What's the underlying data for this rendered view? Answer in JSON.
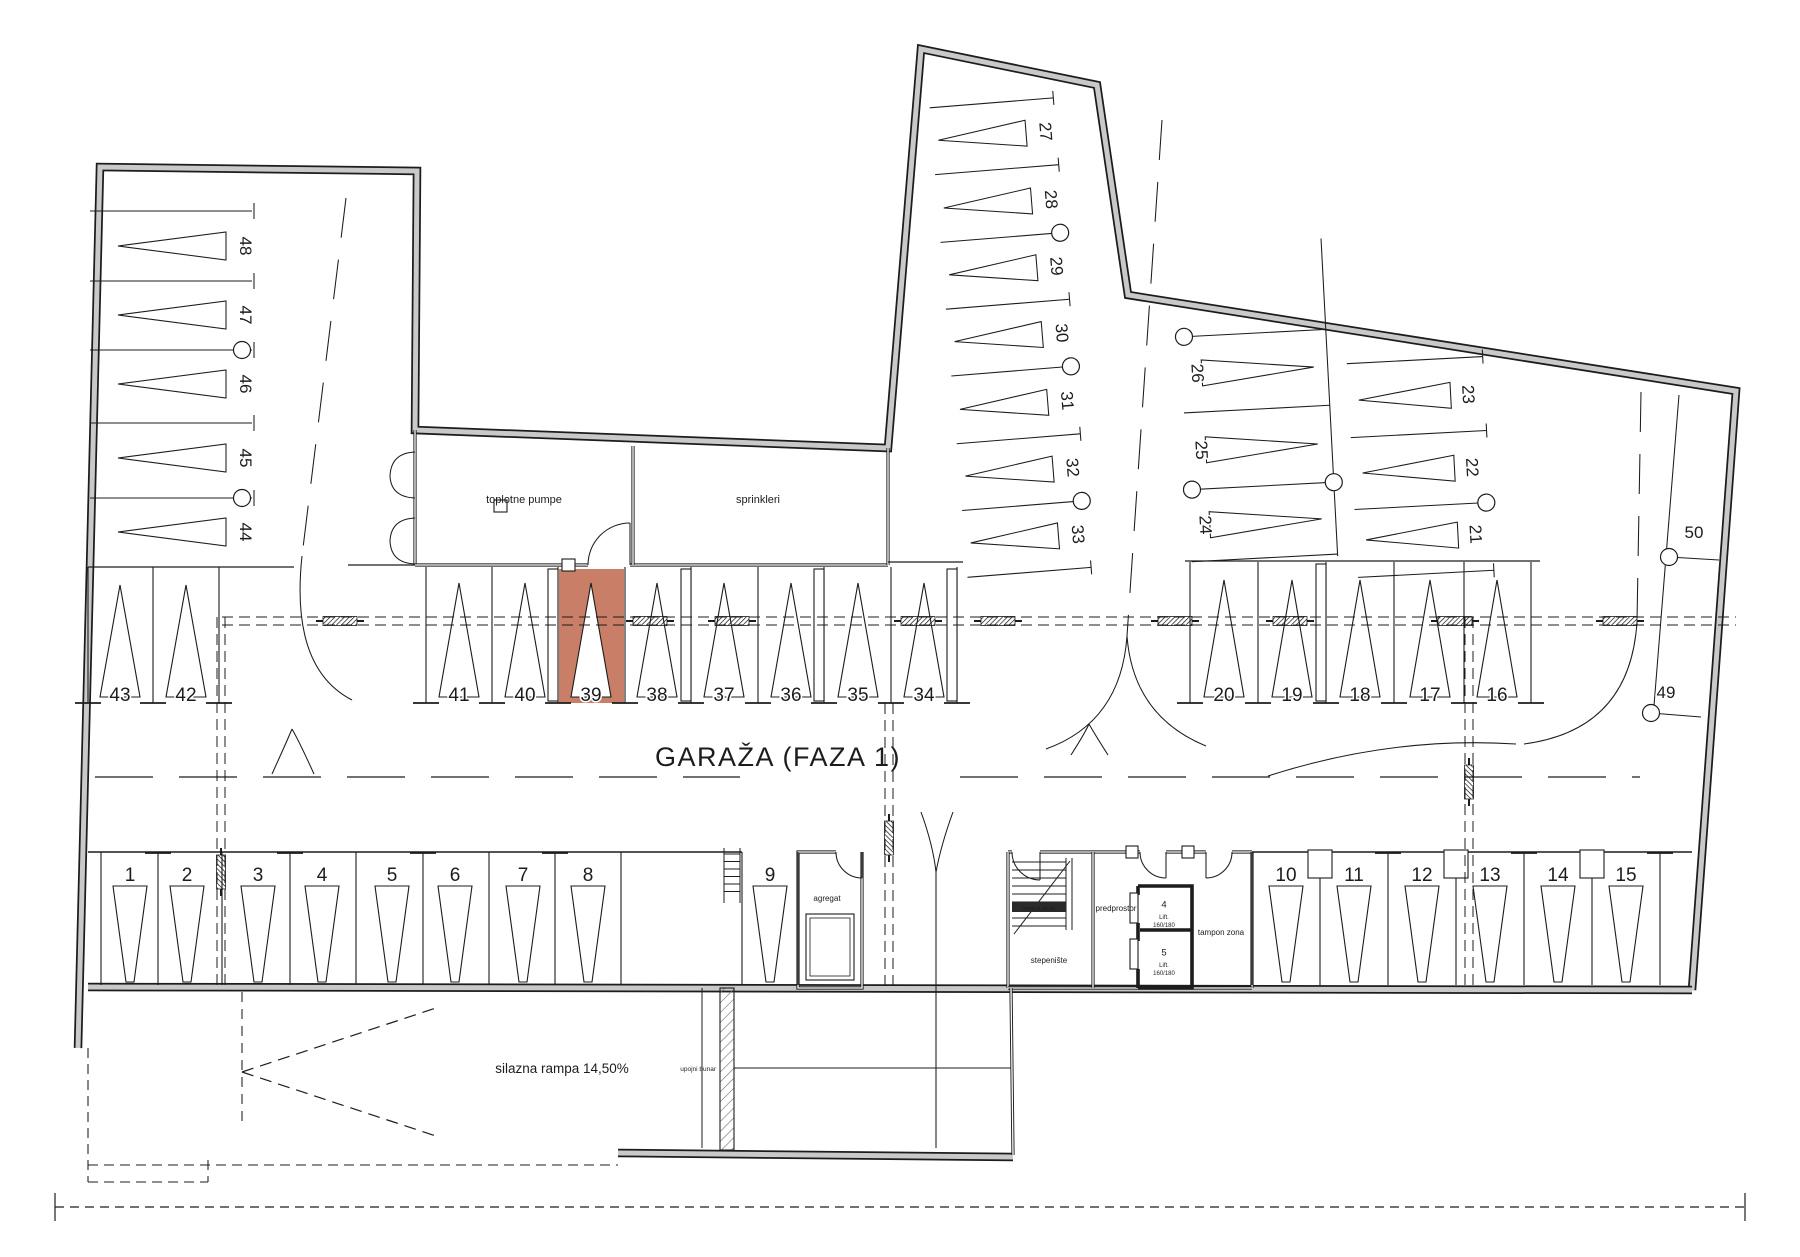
{
  "title": "GARAŽA  (FAZA 1)",
  "rooms": {
    "heat_pumps": "toplotne pumpe",
    "sprinklers": "sprinkleri",
    "generator": "agregat",
    "staircase": "stepenište",
    "stair_booth": "stanica za pp",
    "vestibule": "predprostor",
    "buffer_zone": "tampon zona",
    "ramp": "silazna rampa 14,50%",
    "well": "upojni bunar"
  },
  "lifts": {
    "lift4": {
      "number": "4",
      "label": "Lift.",
      "size": "160/180"
    },
    "lift5": {
      "number": "5",
      "label": "Lift.",
      "size": "160/180"
    }
  },
  "stalls": {
    "middle_row": [
      "43",
      "42",
      "41",
      "40",
      "39",
      "38",
      "37",
      "36",
      "35",
      "34",
      "20",
      "19",
      "18",
      "17",
      "16"
    ],
    "bottom_row": [
      "1",
      "2",
      "3",
      "4",
      "5",
      "6",
      "7",
      "8",
      "9",
      "10",
      "11",
      "12",
      "13",
      "14",
      "15"
    ],
    "left_wing": [
      "48",
      "47",
      "46",
      "45",
      "44"
    ],
    "top_wing": [
      "27",
      "28",
      "29",
      "30",
      "31",
      "32",
      "33"
    ],
    "right_inner_column": [
      "26",
      "25",
      "24"
    ],
    "right_outer_column": [
      "23",
      "22",
      "21"
    ],
    "right_wall": [
      "50",
      "49"
    ]
  },
  "highlight": {
    "stall": "39",
    "color": "#c87e67"
  },
  "colors": {
    "background": "#ffffff",
    "line": "#1c1c1c",
    "wall_fill": "#c9c9c9",
    "stair_band": "#2a2a2a"
  }
}
